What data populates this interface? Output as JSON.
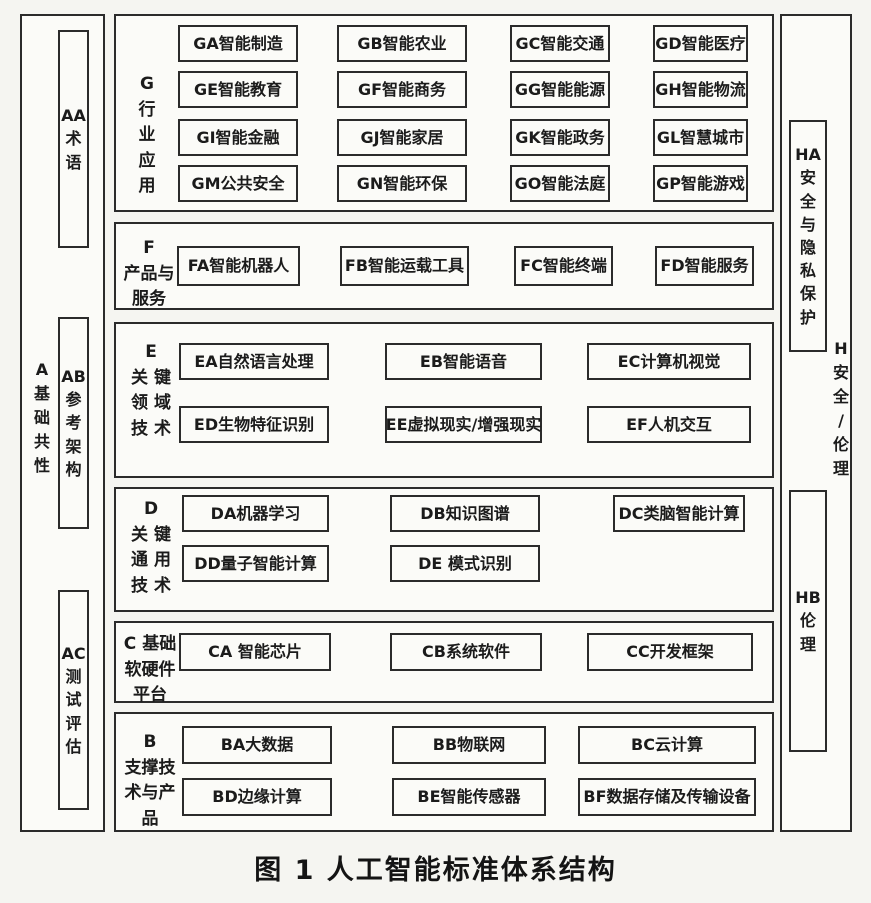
{
  "caption": "图 1 人工智能标准体系结构",
  "colors": {
    "border": "#2b2b2b",
    "text": "#1b1b1b",
    "background": "#f5f5f1",
    "box_background": "#fbfbf8"
  },
  "left_column": {
    "label": "A 基础共性",
    "label_lines": [
      "A",
      "基",
      "础",
      "共",
      "性"
    ],
    "items": [
      {
        "id": "AA",
        "label": "AA术语",
        "lines": [
          "AA",
          "术",
          "语"
        ]
      },
      {
        "id": "AB",
        "label": "AB参考架构",
        "lines": [
          "AB",
          "参",
          "考",
          "架",
          "构"
        ]
      },
      {
        "id": "AC",
        "label": "AC测试评估",
        "lines": [
          "AC",
          "测",
          "试",
          "评",
          "估"
        ]
      }
    ]
  },
  "right_column": {
    "label": "H 安全/伦理",
    "label_lines": [
      "H",
      "安",
      "全",
      "/",
      "伦",
      "理"
    ],
    "items": [
      {
        "id": "HA",
        "label": "HA安全与隐私保护",
        "lines": [
          "HA",
          "安",
          "全",
          "与",
          "隐",
          "私",
          "保",
          "护"
        ]
      },
      {
        "id": "HB",
        "label": "HB伦理",
        "lines": [
          "HB",
          "伦",
          "理"
        ]
      }
    ]
  },
  "sections": [
    {
      "id": "G",
      "label": "G行业应用",
      "label_lines": [
        "G",
        "行",
        "业",
        "应",
        "用"
      ],
      "rows": [
        [
          "GA智能制造",
          "GB智能农业",
          "GC智能交通",
          "GD智能医疗"
        ],
        [
          "GE智能教育",
          "GF智能商务",
          "GG智能能源",
          "GH智能物流"
        ],
        [
          "GI智能金融",
          "GJ智能家居",
          "GK智能政务",
          "GL智慧城市"
        ],
        [
          "GM公共安全",
          "GN智能环保",
          "GO智能法庭",
          "GP智能游戏"
        ]
      ]
    },
    {
      "id": "F",
      "label": "F产品与服务",
      "label_lines": [
        "F",
        "产品与",
        "服务"
      ],
      "rows": [
        [
          "FA智能机器人",
          "FB智能运载工具",
          "FC智能终端",
          "FD智能服务"
        ]
      ]
    },
    {
      "id": "E",
      "label": "E关键领域技术",
      "label_lines": [
        "E",
        "关 键",
        "领 域",
        "技 术"
      ],
      "rows": [
        [
          "EA自然语言处理",
          "EB智能语音",
          "EC计算机视觉"
        ],
        [
          "ED生物特征识别",
          "EE虚拟现实/增强现实",
          "EF人机交互"
        ]
      ]
    },
    {
      "id": "D",
      "label": "D关键通用技术",
      "label_lines": [
        "D",
        "关 键",
        "通 用",
        "技 术"
      ],
      "rows": [
        [
          "DA机器学习",
          "DB知识图谱",
          "DC类脑智能计算"
        ],
        [
          "DD量子智能计算",
          "DE 模式识别"
        ]
      ]
    },
    {
      "id": "C",
      "label": "C基础软硬件平台",
      "label_lines": [
        "C 基础",
        "软硬件",
        "平台"
      ],
      "rows": [
        [
          "CA 智能芯片",
          "CB系统软件",
          "CC开发框架"
        ]
      ]
    },
    {
      "id": "B",
      "label": "B支撑技术与产品",
      "label_lines": [
        "B",
        "支撑技",
        "术与产",
        "品"
      ],
      "rows": [
        [
          "BA大数据",
          "BB物联网",
          "BC云计算"
        ],
        [
          "BD边缘计算",
          "BE智能传感器",
          "BF数据存储及传输设备"
        ]
      ]
    }
  ]
}
